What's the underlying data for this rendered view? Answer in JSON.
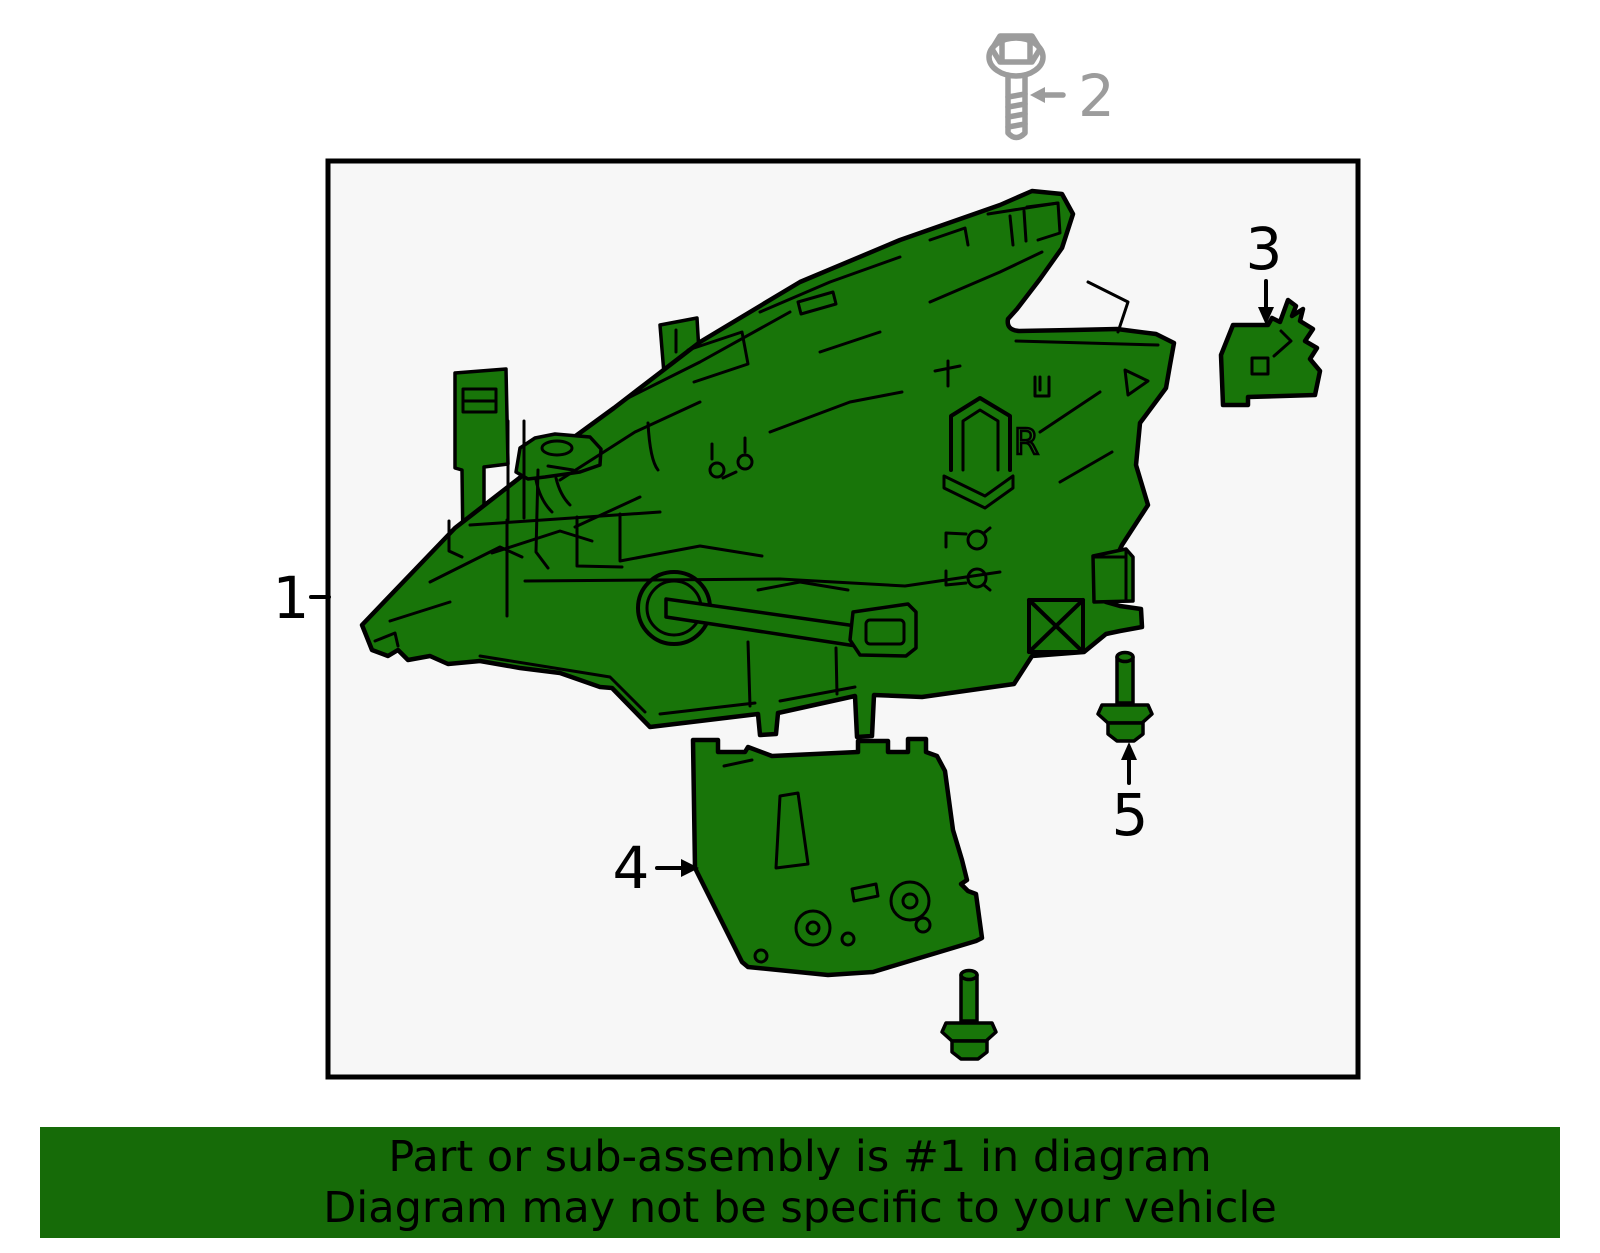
{
  "banner": {
    "line1": "Part or sub-assembly is #1 in diagram",
    "line2": "Diagram may not be specific to your vehicle"
  },
  "callouts": {
    "part1": "1",
    "part2": "2",
    "part3": "3",
    "part4": "4",
    "part5": "5"
  },
  "markings": {
    "r_stamp": "R"
  },
  "colors": {
    "part_green": "#187509",
    "banner_green": "#166b08",
    "outline_black": "#000000",
    "gray_part": "#9c9c9c",
    "box_bg": "#f7f7f7",
    "page_bg": "#ffffff",
    "banner_text": "#000000"
  }
}
